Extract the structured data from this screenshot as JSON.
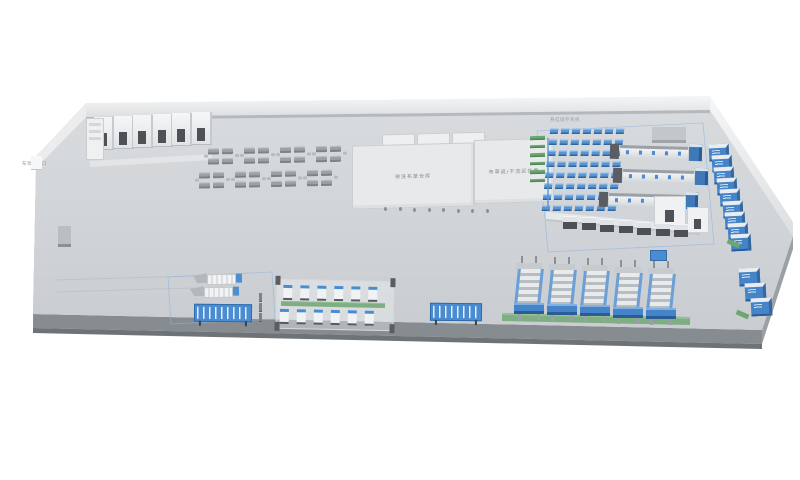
{
  "labels": {
    "exit_left": "布草出入口",
    "room_hvac": "空调间",
    "room_compressor": "空压间",
    "room_power": "配电间",
    "warehouse": "待洗布草仓库",
    "sorting_area": "布草返/干洗区位置",
    "hanging_system": "悬挂储存系统"
  },
  "colors": {
    "accent_blue": "#4a8cd2",
    "dark_blue": "#2f6ca8",
    "accent_green": "#6da671",
    "floor_gray": "#d0d4d7",
    "slab_gray": "#878c90",
    "wall_white": "#f2f3f4",
    "machine_dark": "#55585c"
  },
  "equipment": {
    "top_rooms": 6,
    "desk_clusters_row": 4,
    "rack_cells": 56,
    "rack_shelves": 6,
    "ironer_ticks": 5,
    "wall_machines": 9,
    "corner_machines": 3,
    "folder_units": 7,
    "press_units": 5,
    "station_units": 6,
    "conveyor_feeders": 2,
    "conveyor_posts": 3,
    "pillar_dots": 8
  }
}
